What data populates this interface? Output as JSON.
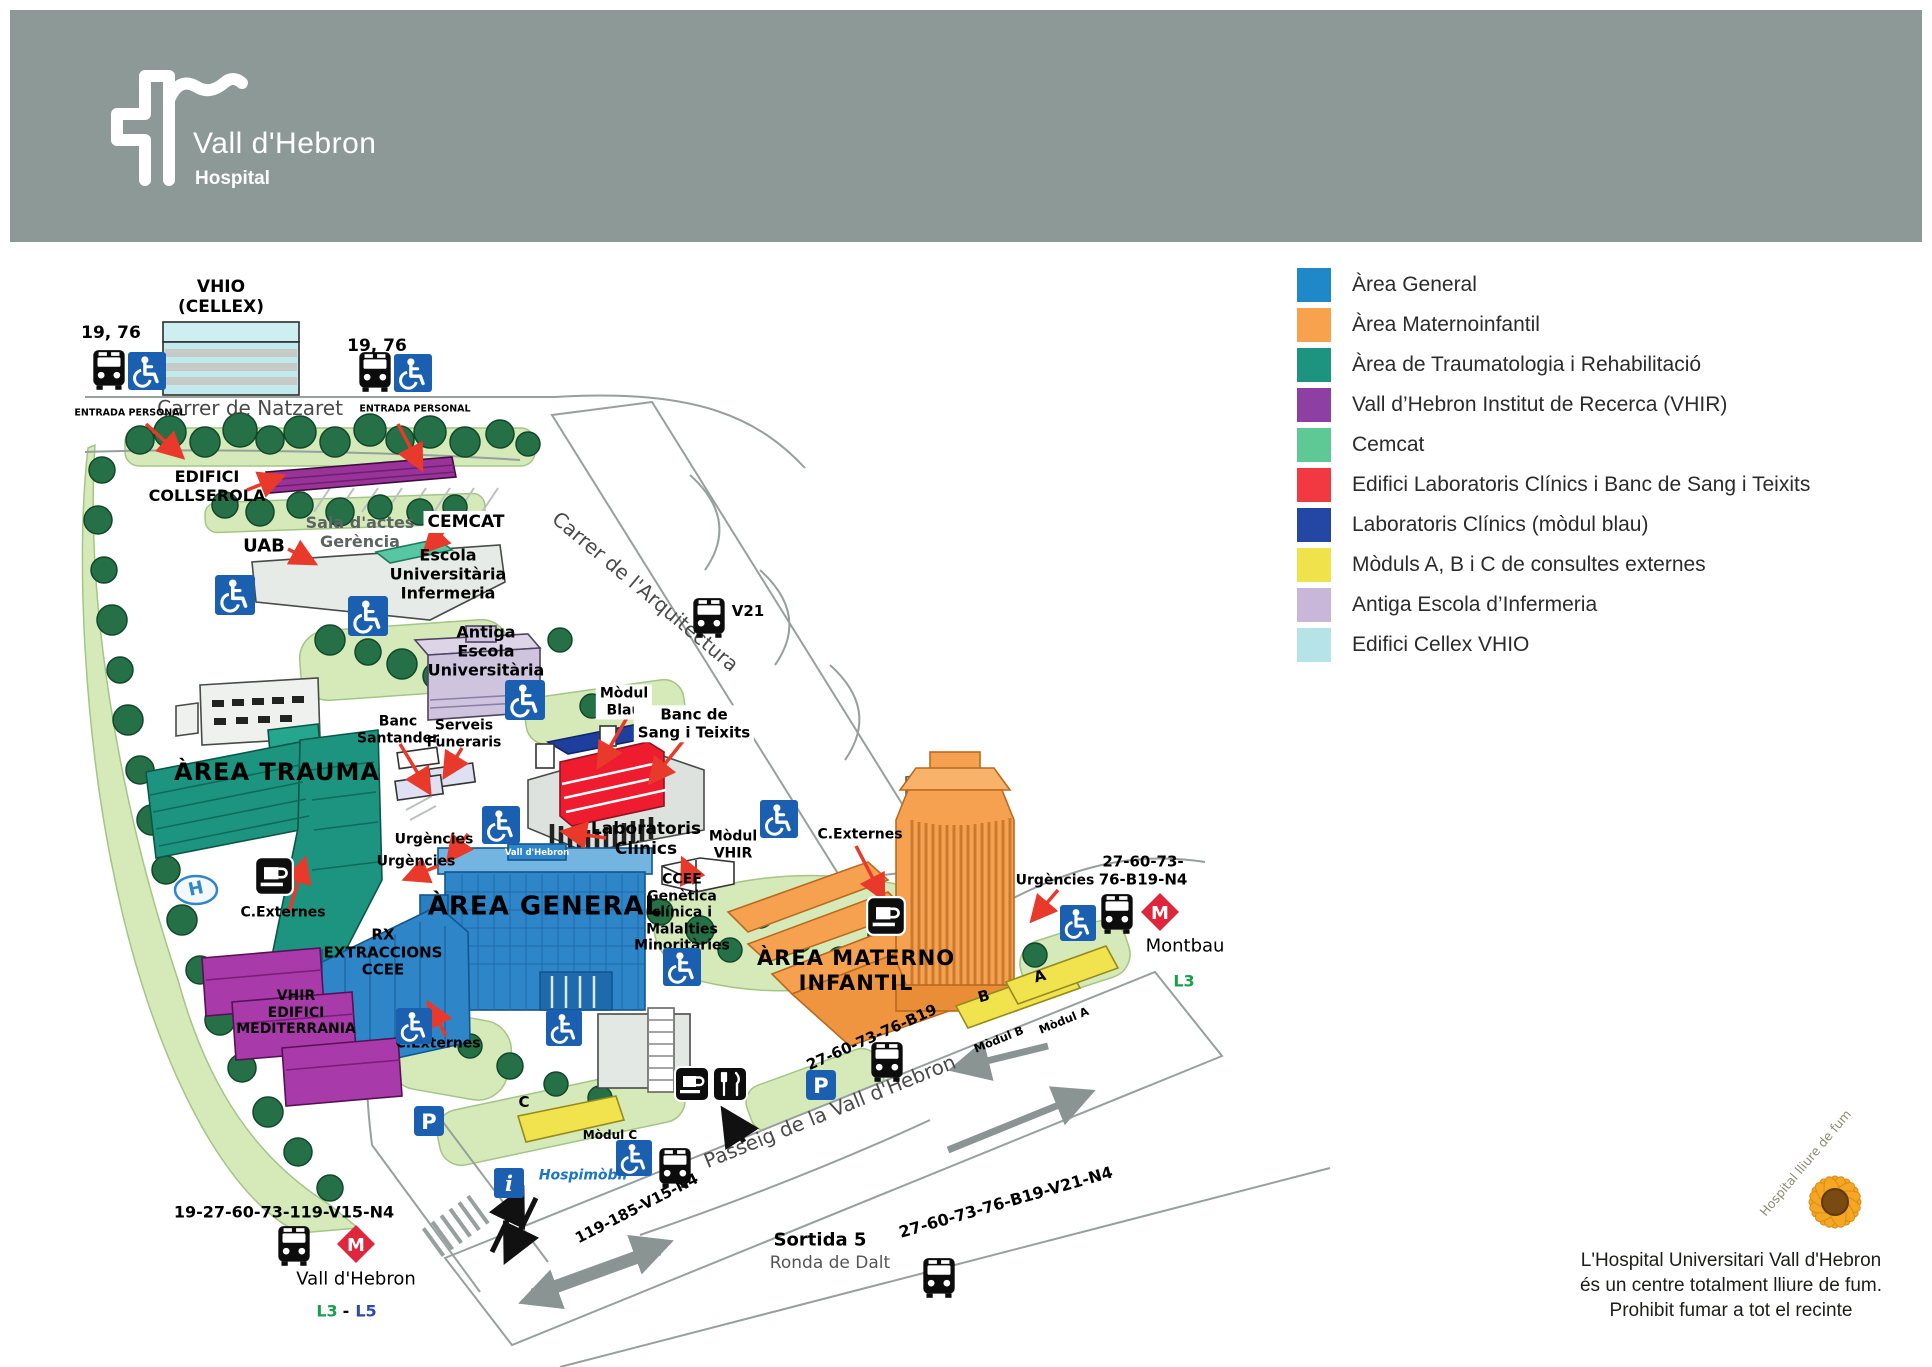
{
  "header": {
    "title": "Vall d'Hebron",
    "subtitle": "Hospital"
  },
  "legend": {
    "items": [
      {
        "label": "Àrea General",
        "color": "#1e88c8"
      },
      {
        "label": "Àrea Maternoinfantil",
        "color": "#f9a24e"
      },
      {
        "label": "Àrea de Traumatologia i Rehabilitació",
        "color": "#1d9480"
      },
      {
        "label": "Vall d’Hebron Institut de Recerca (VHIR)",
        "color": "#8e3fa3"
      },
      {
        "label": "Cemcat",
        "color": "#5ec995"
      },
      {
        "label": "Edifici Laboratoris Clínics  i Banc de Sang i Teixits",
        "color": "#f23841"
      },
      {
        "label": "Laboratoris Clínics (mòdul blau)",
        "color": "#2447a5"
      },
      {
        "label": "Mòduls A, B i C de consultes externes",
        "color": "#efe24b"
      },
      {
        "label": "Antiga Escola d’Infermeria",
        "color": "#c8b7d8"
      },
      {
        "label": "Edifici Cellex VHIO",
        "color": "#b5e3e8"
      }
    ]
  },
  "map": {
    "labels": [
      {
        "name": "vhio-label",
        "text": "VHIO",
        "x": 221,
        "y": 287,
        "size": 17,
        "bold": true
      },
      {
        "name": "cellex-label",
        "text": "(CELLEX)",
        "x": 221,
        "y": 307,
        "size": 17,
        "bold": true
      },
      {
        "name": "bus-19-76-left-label",
        "text": "19, 76",
        "x": 111,
        "y": 333,
        "size": 17,
        "bold": true
      },
      {
        "name": "bus-19-76-right-label",
        "text": "19, 76",
        "x": 377,
        "y": 346,
        "size": 17,
        "bold": true
      },
      {
        "name": "street-natzaret",
        "text": "Carrer de Natzaret",
        "x": 250,
        "y": 409,
        "size": 20,
        "color": "#4a4a4a"
      },
      {
        "name": "entrada-personal-left",
        "text": "ENTRADA PERSONAL",
        "x": 130,
        "y": 413,
        "size": 9.5,
        "bold": true
      },
      {
        "name": "entrada-personal-right",
        "text": "ENTRADA PERSONAL",
        "x": 415,
        "y": 409,
        "size": 9.5,
        "bold": true
      },
      {
        "name": "edifici-collserola-label",
        "text": "EDIFICI\nCOLLSEROLA",
        "x": 207,
        "y": 487,
        "size": 16,
        "bold": true
      },
      {
        "name": "sala-dactes-label",
        "text": "Sala d'actes\nGerència",
        "x": 360,
        "y": 533,
        "size": 16,
        "bold": true,
        "color": "#5c6462"
      },
      {
        "name": "uab-label",
        "text": "UAB",
        "x": 264,
        "y": 546,
        "size": 18,
        "bold": true
      },
      {
        "name": "cemcat-label",
        "text": "CEMCAT",
        "x": 466,
        "y": 522,
        "size": 17,
        "bold": true,
        "bg": "#fff"
      },
      {
        "name": "escola-infermeria-label",
        "text": "Escola\nUniversitària\nInfermeria",
        "x": 448,
        "y": 575,
        "size": 16,
        "bold": true
      },
      {
        "name": "antiga-escola-label",
        "text": "Antiga\nEscola\nUniversitària",
        "x": 486,
        "y": 652,
        "size": 16,
        "bold": true
      },
      {
        "name": "street-arquitectura",
        "text": "Carrer de l'Arquitectura",
        "x": 645,
        "y": 592,
        "size": 20,
        "color": "#4a4a4a",
        "rotate": 40
      },
      {
        "name": "v21-label",
        "text": "V21",
        "x": 748,
        "y": 612,
        "size": 15,
        "bold": true
      },
      {
        "name": "banc-santander-label",
        "text": "Banc\nSantander",
        "x": 398,
        "y": 730,
        "size": 14,
        "bold": true
      },
      {
        "name": "serveis-funeraris-label",
        "text": "Serveis\nFuneraris",
        "x": 464,
        "y": 734,
        "size": 14,
        "bold": true
      },
      {
        "name": "modul-blau-label",
        "text": "Mòdul\nBlau",
        "x": 624,
        "y": 702,
        "size": 14,
        "bold": true,
        "bg": "#fff"
      },
      {
        "name": "banc-sang-label",
        "text": "Banc de\nSang i Teixits",
        "x": 694,
        "y": 724,
        "size": 15,
        "bold": true,
        "bg": "#fff"
      },
      {
        "name": "area-trauma-label",
        "text": "ÀREA TRAUMA",
        "x": 277,
        "y": 772,
        "size": 24,
        "bold": true,
        "spacing": 1
      },
      {
        "name": "urgencies-label-1",
        "text": "Urgències",
        "x": 434,
        "y": 840,
        "size": 14,
        "bold": true
      },
      {
        "name": "urgencies-label-2",
        "text": "Urgències",
        "x": 416,
        "y": 862,
        "size": 14,
        "bold": true
      },
      {
        "name": "laboratoris-clinics-label",
        "text": "Laboratoris\nClínics",
        "x": 646,
        "y": 839,
        "size": 17,
        "bold": true
      },
      {
        "name": "modul-vhir-label",
        "text": "Mòdul\nVHIR",
        "x": 733,
        "y": 845,
        "size": 14,
        "bold": true
      },
      {
        "name": "ccee-genetica-label",
        "text": "CCEE\nGenètica\nclínica i\nMalalties\nMinoritàries",
        "x": 682,
        "y": 913,
        "size": 14,
        "bold": true
      },
      {
        "name": "area-general-label",
        "text": "ÀREA GENERAL",
        "x": 545,
        "y": 907,
        "size": 26,
        "bold": true,
        "spacing": 1
      },
      {
        "name": "c-externes-label-1",
        "text": "C.Externes",
        "x": 283,
        "y": 913,
        "size": 14,
        "bold": true
      },
      {
        "name": "rx-extraccions-label",
        "text": "RX\nEXTRACCIONS\nCCEE",
        "x": 383,
        "y": 953,
        "size": 15,
        "bold": true
      },
      {
        "name": "vhir-mediterrania-label",
        "text": "VHIR\nEDIFICI\nMEDITERRANIA",
        "x": 296,
        "y": 1013,
        "size": 14,
        "bold": true
      },
      {
        "name": "c-externes-label-2",
        "text": "C.Externes",
        "x": 438,
        "y": 1044,
        "size": 14,
        "bold": true
      },
      {
        "name": "c-externes-label-3",
        "text": "C.Externes",
        "x": 860,
        "y": 835,
        "size": 14,
        "bold": true
      },
      {
        "name": "urgencies-label-3",
        "text": "Urgències",
        "x": 1055,
        "y": 881,
        "size": 14,
        "bold": true
      },
      {
        "name": "bus-route-montbau-label",
        "text": "27-60-73-\n76-B19-N4",
        "x": 1143,
        "y": 871,
        "size": 15,
        "bold": true
      },
      {
        "name": "montbau-label",
        "text": "Montbau",
        "x": 1185,
        "y": 946,
        "size": 18
      },
      {
        "name": "l3-montbau-label",
        "text": "L3",
        "x": 1184,
        "y": 982,
        "size": 16,
        "bold": true,
        "color": "#18a04b"
      },
      {
        "name": "area-materno-label",
        "text": "ÀREA MATERNO\nINFANTIL",
        "x": 856,
        "y": 971,
        "size": 21,
        "bold": true,
        "spacing": 1
      },
      {
        "name": "bus-route-b19-label",
        "text": "27-60-73-76-B19",
        "x": 872,
        "y": 1038,
        "size": 15,
        "bold": true,
        "rotate": -24
      },
      {
        "name": "modul-b-label",
        "text": "Mòdul B",
        "x": 999,
        "y": 1040,
        "size": 11.5,
        "bold": true,
        "rotate": -22
      },
      {
        "name": "modul-a-label",
        "text": "Mòdul A",
        "x": 1064,
        "y": 1021,
        "size": 11.5,
        "bold": true,
        "rotate": -22
      },
      {
        "name": "letter-b-label",
        "text": "B",
        "x": 984,
        "y": 997,
        "size": 15,
        "bold": true,
        "rotate": -15
      },
      {
        "name": "letter-a-label",
        "text": "A",
        "x": 1040,
        "y": 977,
        "size": 15,
        "bold": true,
        "rotate": -15
      },
      {
        "name": "street-passeig",
        "text": "Passeig de la Vall d'Hebron",
        "x": 830,
        "y": 1112,
        "size": 20,
        "color": "#4a4a4a",
        "rotate": -22
      },
      {
        "name": "modul-c-label",
        "text": "Mòdul C",
        "x": 610,
        "y": 1135,
        "size": 12,
        "bold": true
      },
      {
        "name": "letter-c-label",
        "text": "C",
        "x": 524,
        "y": 1103,
        "size": 15,
        "bold": true
      },
      {
        "name": "hospimobil-label",
        "text": "Hospimòbil",
        "x": 583,
        "y": 1176,
        "size": 14,
        "bold": true,
        "italic": true,
        "color": "#1b74c4"
      },
      {
        "name": "bus-route-119-label",
        "text": "119-185-V15-N4",
        "x": 637,
        "y": 1209,
        "size": 15,
        "bold": true,
        "rotate": -27
      },
      {
        "name": "bus-route-19-27-label",
        "text": "19-27-60-73-119-V15-N4",
        "x": 284,
        "y": 1213,
        "size": 16,
        "bold": true
      },
      {
        "name": "vall-dhebron-stop-label",
        "text": "Vall d'Hebron",
        "x": 356,
        "y": 1279,
        "size": 18
      },
      {
        "name": "l3-bottom-label",
        "text": "L3",
        "x": 327,
        "y": 1312,
        "size": 16,
        "bold": true,
        "color": "#18a04b"
      },
      {
        "name": "l3-l5-dash",
        "text": "-",
        "x": 346,
        "y": 1312,
        "size": 16,
        "bold": true
      },
      {
        "name": "l5-bottom-label",
        "text": "L5",
        "x": 366,
        "y": 1312,
        "size": 16,
        "bold": true,
        "color": "#2b4bab"
      },
      {
        "name": "sortida-5-label",
        "text": "Sortida 5",
        "x": 820,
        "y": 1240,
        "size": 18,
        "bold": true
      },
      {
        "name": "ronda-de-dalt-label",
        "text": "Ronda de Dalt",
        "x": 830,
        "y": 1263,
        "size": 17,
        "color": "#555555"
      },
      {
        "name": "bus-route-v21-n4-label",
        "text": "27-60-73-76-B19-V21-N4",
        "x": 1006,
        "y": 1203,
        "size": 16,
        "bold": true,
        "rotate": -16
      },
      {
        "name": "helipad-h-label",
        "text": "H",
        "x": 196,
        "y": 889,
        "size": 18,
        "bold": true,
        "color": "#2f86c8",
        "rotate": -12
      },
      {
        "name": "general-roof-sign",
        "text": "Vall d'Hebron",
        "x": 537,
        "y": 853,
        "size": 8.5,
        "bold": true,
        "color": "#ffffff"
      }
    ],
    "icons": [
      {
        "type": "bus",
        "x": 90,
        "y": 348,
        "s": 38
      },
      {
        "type": "accessibility",
        "x": 128,
        "y": 352,
        "s": 38
      },
      {
        "type": "bus",
        "x": 356,
        "y": 350,
        "s": 38
      },
      {
        "type": "accessibility",
        "x": 394,
        "y": 354,
        "s": 38
      },
      {
        "type": "accessibility",
        "x": 215,
        "y": 575,
        "s": 40
      },
      {
        "type": "accessibility",
        "x": 348,
        "y": 596,
        "s": 40
      },
      {
        "type": "bus",
        "x": 690,
        "y": 596,
        "s": 38
      },
      {
        "type": "accessibility",
        "x": 505,
        "y": 680,
        "s": 40
      },
      {
        "type": "accessibility",
        "x": 482,
        "y": 806,
        "s": 38
      },
      {
        "type": "cafe",
        "x": 254,
        "y": 856,
        "s": 40
      },
      {
        "type": "accessibility",
        "x": 663,
        "y": 948,
        "s": 38
      },
      {
        "type": "accessibility",
        "x": 760,
        "y": 800,
        "s": 38
      },
      {
        "type": "cafe",
        "x": 866,
        "y": 896,
        "s": 40
      },
      {
        "type": "accessibility",
        "x": 396,
        "y": 1008,
        "s": 36
      },
      {
        "type": "accessibility",
        "x": 546,
        "y": 1010,
        "s": 36
      },
      {
        "type": "accessibility",
        "x": 616,
        "y": 1140,
        "s": 36
      },
      {
        "type": "accessibility",
        "x": 1060,
        "y": 905,
        "s": 36
      },
      {
        "type": "bus",
        "x": 1098,
        "y": 892,
        "s": 38
      },
      {
        "type": "metro",
        "x": 1140,
        "y": 892,
        "s": 40
      },
      {
        "type": "bus",
        "x": 868,
        "y": 1040,
        "s": 38
      },
      {
        "type": "parking",
        "x": 806,
        "y": 1070,
        "s": 30
      },
      {
        "type": "parking",
        "x": 414,
        "y": 1106,
        "s": 30
      },
      {
        "type": "cafe",
        "x": 674,
        "y": 1066,
        "s": 36
      },
      {
        "type": "restaurant",
        "x": 712,
        "y": 1066,
        "s": 36
      },
      {
        "type": "bus",
        "x": 656,
        "y": 1146,
        "s": 38
      },
      {
        "type": "info",
        "x": 494,
        "y": 1168,
        "s": 30
      },
      {
        "type": "bus",
        "x": 275,
        "y": 1224,
        "s": 38
      },
      {
        "type": "metro",
        "x": 336,
        "y": 1224,
        "s": 40
      },
      {
        "type": "bus",
        "x": 920,
        "y": 1256,
        "s": 38
      }
    ]
  },
  "footer": {
    "lines": [
      "L'Hospital Universitari Vall d'Hebron",
      "és un centre totalment lliure de fum.",
      "Prohibit fumar a tot el recinte"
    ]
  },
  "flower": {
    "caption": "Hospital lliure de fum"
  }
}
